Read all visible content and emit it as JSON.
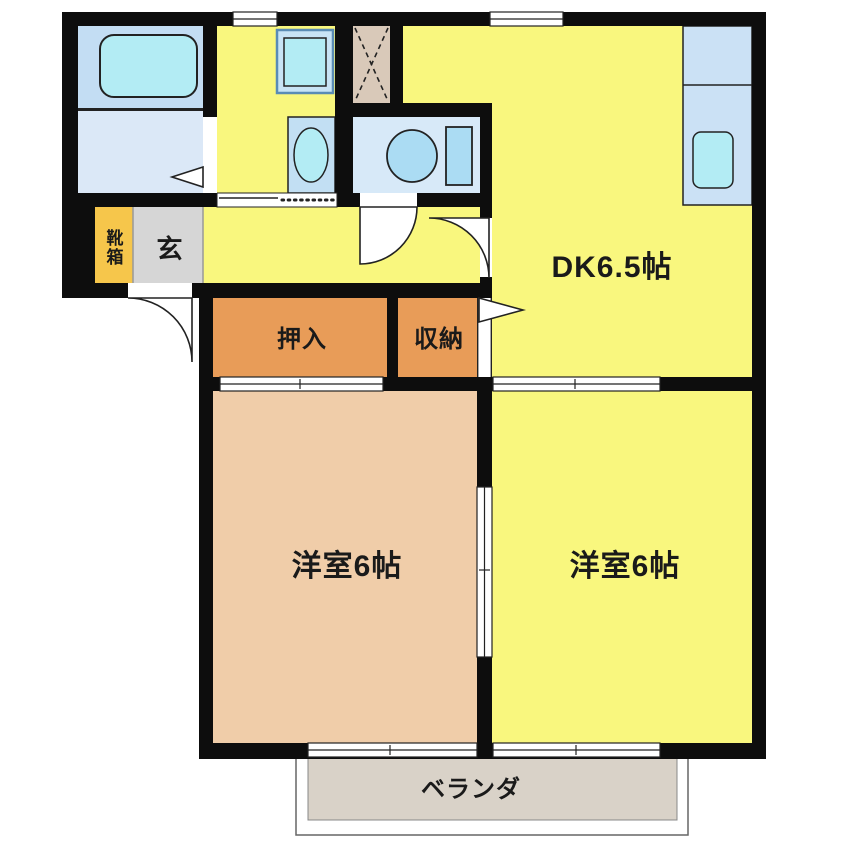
{
  "plan": {
    "type": "floor-plan",
    "layout_name": "2DK",
    "rooms": {
      "dk": "DK6.5帖",
      "bedroom_left": "洋室6帖",
      "bedroom_right": "洋室6帖",
      "closet": "押入",
      "storage": "収納",
      "entrance": "玄",
      "shoebox": "靴箱",
      "veranda": "ベランダ"
    },
    "colors": {
      "wall": "#0d0d0d",
      "room_yellow": "#F9F77E",
      "room_tan": "#F0CDA9",
      "closet_orange": "#E89C58",
      "shoebox_amber": "#F6C64B",
      "entrance_gray": "#D6D6D6",
      "veranda_gray": "#D9D2C8",
      "bath_bg": "#C3DDF3",
      "bath_floor": "#DBE8F7",
      "toilet_bg": "#D7E9F8",
      "counter_blue": "#CBE1F5",
      "basin_blue": "#C2DFF3",
      "fixture_cyan": "#B3ECF4",
      "fixture_blue": "#ABDCF3",
      "machine_frame": "#5A8CB5",
      "machine_fill": "#C8E4F5",
      "hatch_tan": "#D9C9B9",
      "opening_white": "#FFFFFF",
      "label": "#1a1a1a"
    }
  }
}
